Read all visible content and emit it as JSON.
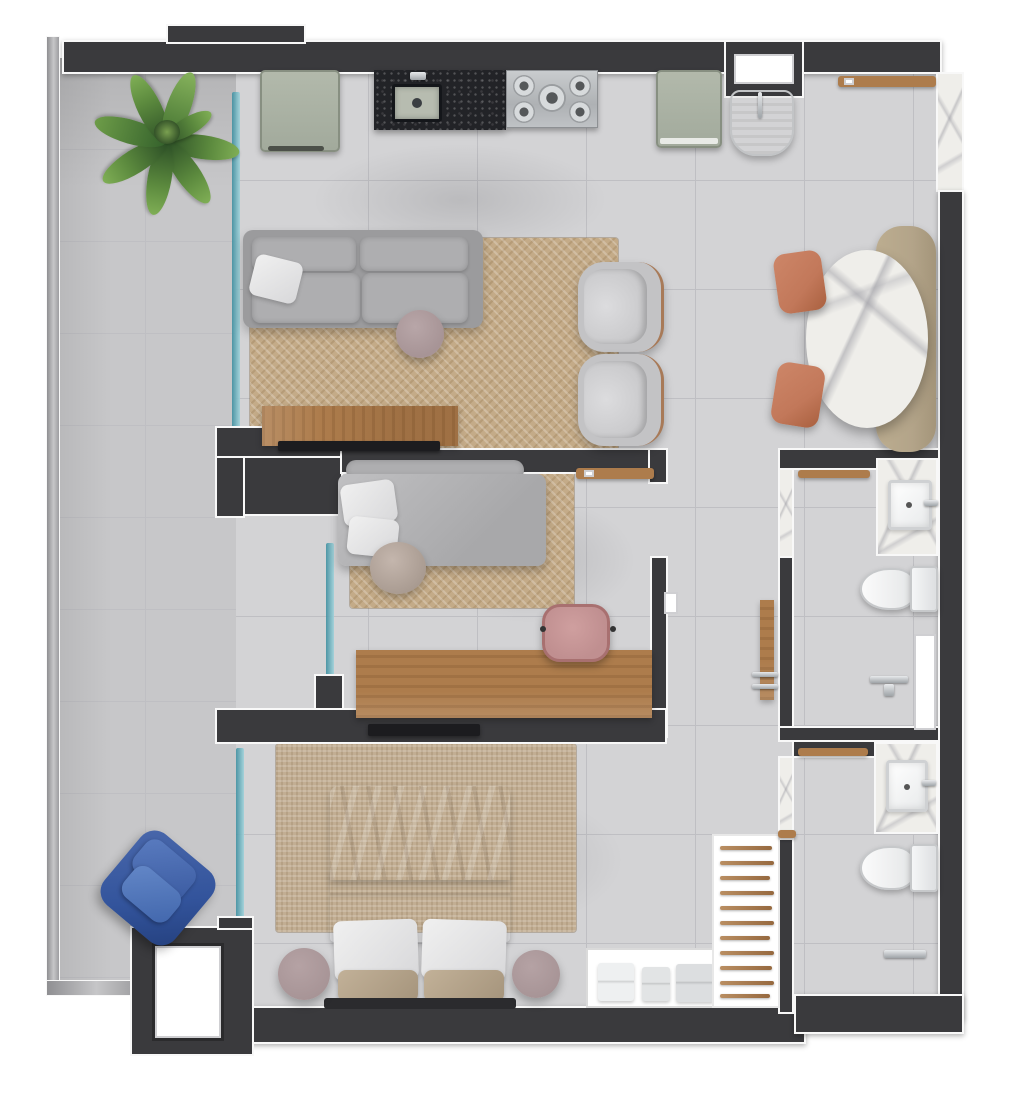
{
  "meta": {
    "kind": "apartment-floor-plan-top-view",
    "visible_text": []
  },
  "palette": {
    "wall": "#3a3a3d",
    "trim": "#f8f8f8",
    "floorMain": "#d3d3d5",
    "floorBalcony": "#c7c7c9",
    "grout": "#bfbfc3",
    "rugLiving": "#c4ab88",
    "rugMaster": "#c2ae93",
    "wood": "#ad7c4c",
    "granite": "#222327",
    "marble": "#efeeea",
    "glassTeal": "#3f8fa0",
    "sofaGray": "#9b9b9d",
    "cushionGray": "#aeaeb0",
    "mauve": "#a79496",
    "terracotta": "#c2785a",
    "benchTan": "#b3a489",
    "blanketTan": "#b19f88",
    "blueChair": "#33549c",
    "pink": "#c08f90",
    "sage": "#a9b0a3"
  },
  "rooms": [
    {
      "name": "balcony",
      "furniture": [
        "potted-palm-plant",
        "blue-armchair"
      ]
    },
    {
      "name": "kitchen-laundry",
      "furniture": [
        "refrigerator",
        "granite-counter-with-sink",
        "gas-cooktop-5-burners",
        "washing-machine",
        "laundry-tub",
        "wall-shelf",
        "service-window"
      ]
    },
    {
      "name": "living-room",
      "furniture": [
        "gray-sofa",
        "white-throw-pillow",
        "round-side-table",
        "tv-console",
        "tv",
        "herringbone-rug",
        "barrel-armchair",
        "barrel-armchair"
      ]
    },
    {
      "name": "dining-area",
      "furniture": [
        "oval-marble-table",
        "upholstered-bench",
        "terracotta-chair",
        "terracotta-chair"
      ]
    },
    {
      "name": "middle-bedroom-office",
      "furniture": [
        "daybed",
        "bolster",
        "pillows",
        "round-pouf",
        "area-rug",
        "wall-shelf",
        "wood-desk",
        "pink-office-chair"
      ]
    },
    {
      "name": "hallway",
      "furniture": [
        "open-wood-door-leaf",
        "door-handle"
      ]
    },
    {
      "name": "bathroom-top",
      "furniture": [
        "towel-rail",
        "marble-vanity",
        "sink",
        "faucet",
        "toilet",
        "shower-fixture",
        "shower-glass-door"
      ]
    },
    {
      "name": "bathroom-bottom",
      "furniture": [
        "towel-rail",
        "marble-vanity",
        "sink",
        "faucet",
        "toilet",
        "shower-fixture"
      ]
    },
    {
      "name": "master-bedroom",
      "furniture": [
        "double-bed",
        "tan-blanket",
        "white-duvet",
        "pillows",
        "tan-cushions",
        "headboard",
        "round-nightstand",
        "round-nightstand",
        "wall-tv",
        "area-rug",
        "open-shelf-folded-clothes",
        "ladder-clothes-rack"
      ]
    },
    {
      "name": "entry",
      "furniture": [
        "entry-door"
      ]
    }
  ]
}
